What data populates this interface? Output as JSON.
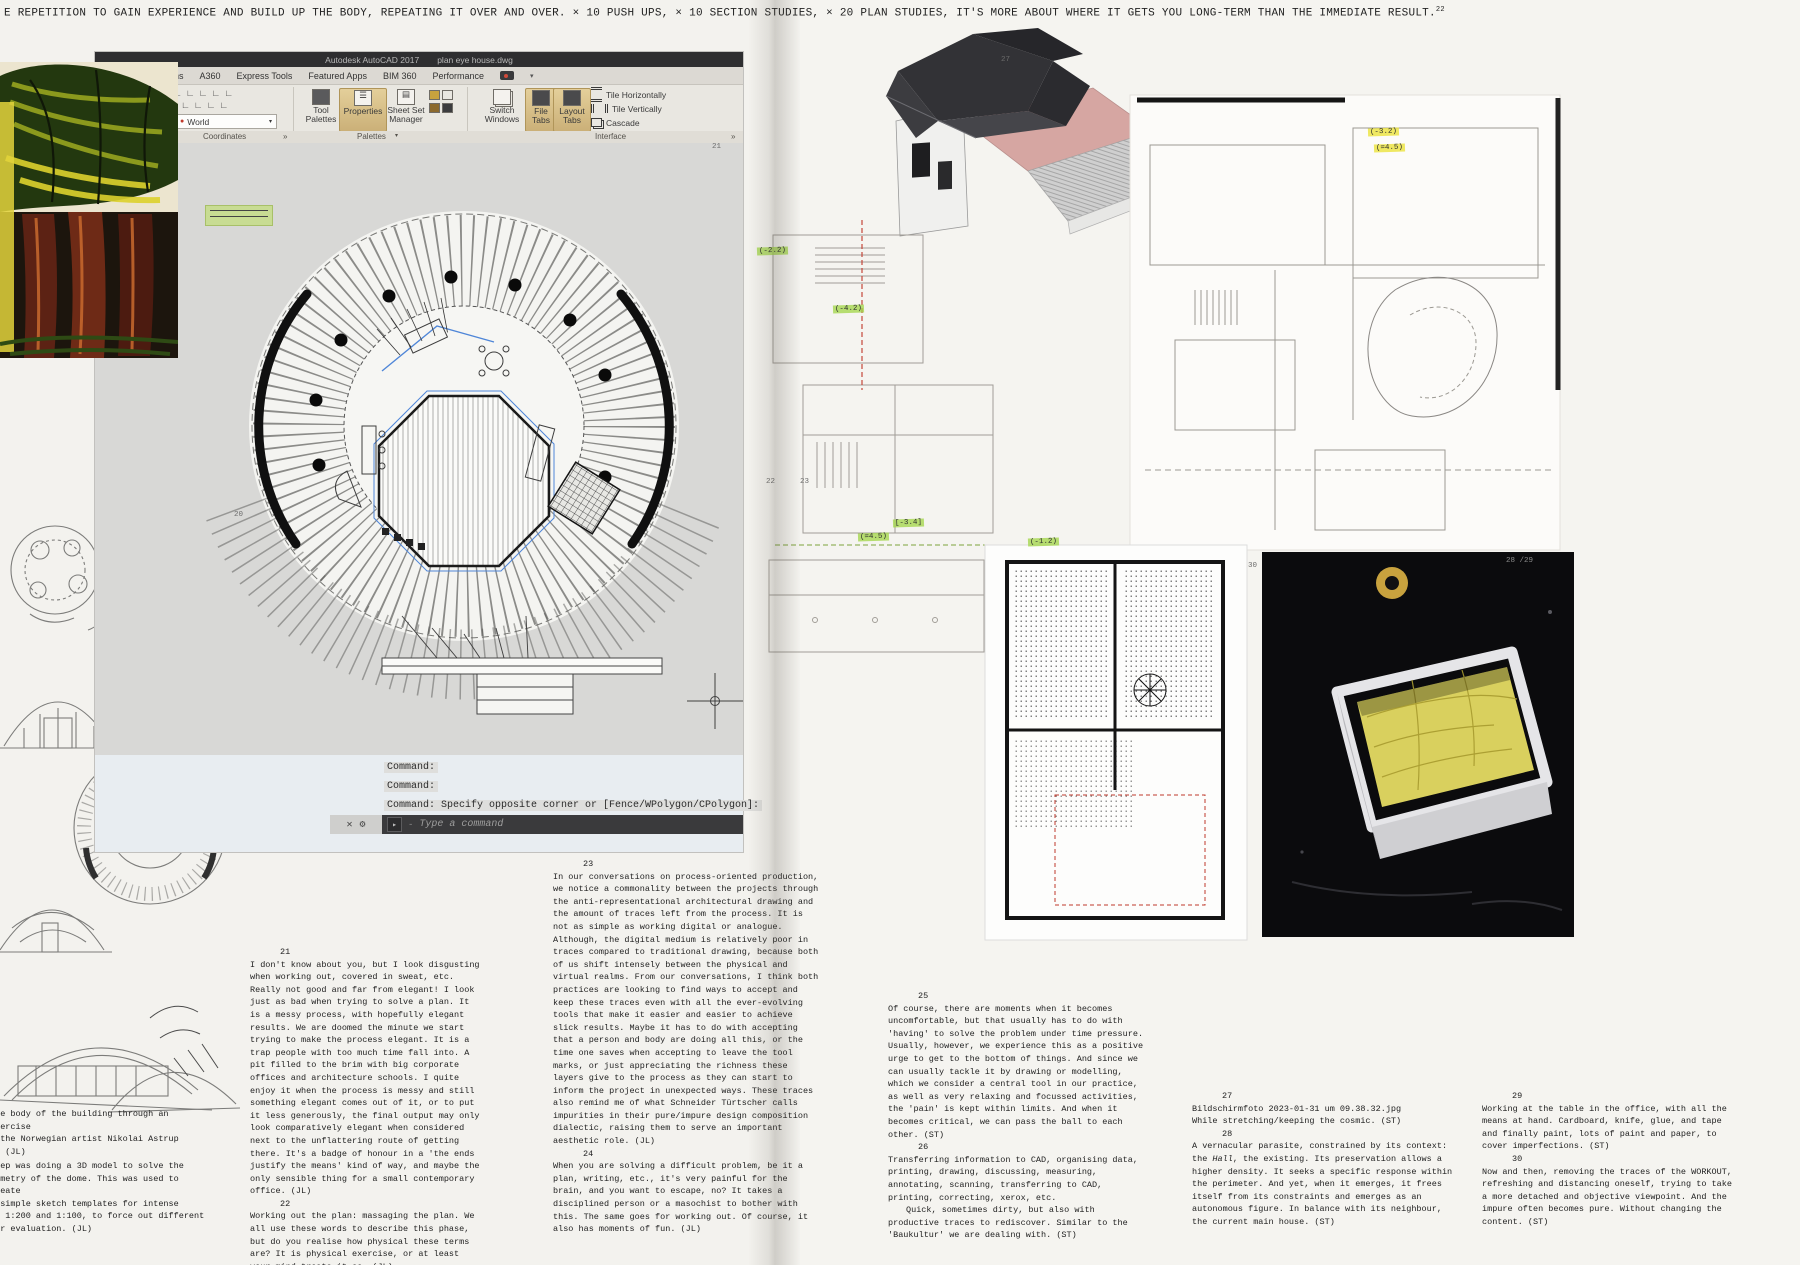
{
  "header": {
    "text": "E REPETITION TO GAIN EXPERIENCE AND BUILD UP THE BODY, REPEATING IT OVER AND OVER. × 10 PUSH UPS, × 10 SECTION STUDIES, × 20 PLAN STUDIES, IT'S MORE ABOUT WHERE IT GETS YOU LONG-TERM THAN THE IMMEDIATE RESULT.",
    "footnote_ref": "22"
  },
  "autocad": {
    "titlebar": {
      "app_title": "Autodesk AutoCAD 2017",
      "doc_title": "plan eye house.dwg"
    },
    "menu_tabs": [
      "Add-ins",
      "A360",
      "Express Tools",
      "Featured Apps",
      "BIM 360",
      "Performance"
    ],
    "ribbon": {
      "partial_label": "amed",
      "world_dropdown": "World",
      "tool_palettes": "Tool Palettes",
      "properties": "Properties",
      "sheet_set_manager": "Sheet Set Manager",
      "switch_windows": "Switch Windows",
      "file_tabs": "File Tabs",
      "layout_tabs": "Layout Tabs",
      "tile_horizontally": "Tile Horizontally",
      "tile_vertically": "Tile Vertically",
      "cascade": "Cascade",
      "panel_labels": {
        "coordinates": "Coordinates",
        "palettes": "Palettes",
        "interface": "Interface"
      }
    },
    "icons": {
      "caret": "▾",
      "expand": "»",
      "close": "✕",
      "wrench": "⚙",
      "prompt": "▸",
      "dash": "-",
      "dot": "●"
    },
    "command_area": {
      "line1": "Command:",
      "line2": "Command:",
      "line3": "Command: Specify opposite corner or [Fence/WPolygon/CPolygon]:",
      "prompt_placeholder": "Type a command"
    }
  },
  "footnotes": {
    "left": [
      {
        "num": "21",
        "text": "I don't know about you, but I look disgusting when working out, covered in sweat, etc. Really not good and far from elegant! I look just as bad when trying to solve a plan. It is a messy process, with hopefully elegant results. We are doomed the minute we start trying to make the process elegant. It is a trap people with too much time fall into. A pit filled to the brim with big corporate offices and architecture schools. I quite enjoy it when the process is messy and still something elegant comes out of it, or to put it less generously, the final output may only look comparatively elegant when considered next to the unflattering route of getting there. It's a badge of honour in a 'the ends justify the means' kind of way, and maybe the only sensible thing for a small contemporary office. (JL)"
      },
      {
        "num": "22",
        "text": "Working out the plan: massaging the plan. We all use these words to describe this phase, but do you realise how physical these terms are? It is physical exercise, or at least your mind treats it so. (JL)"
      }
    ],
    "middle": [
      {
        "num": "23",
        "text": "In our conversations on process-oriented production, we notice a commonality between the projects through the anti-representational architectural drawing and the amount of traces left from the process. It is not as simple as working digital or analogue. Although, the digital medium is relatively poor in traces compared to traditional drawing, because both of us shift intensely between the physical and virtual realms. From our conversations, I think both practices are looking to find ways to accept and keep these traces even with all the ever-evolving tools that make it easier and easier to achieve slick results. Maybe it has to do with accepting that a person and body are doing all this, or the time one saves when accepting to leave the tool marks, or just appreciating the richness these layers give to the process as they can start to inform the project in unexpected ways. These traces also remind me of what Schneider Türtscher calls impurities in their pure/impure design composition dialectic, raising them to serve an important aesthetic role. (JL)"
      },
      {
        "num": "24",
        "text": "When you are solving a difficult problem, be it a plan, writing, etc., it's very painful for the brain, and you want to escape, no? It takes a disciplined person or a masochist to bother with this. The same goes for working out. Of course, it also has moments of fun. (JL)"
      }
    ],
    "right1": [
      {
        "num": "25",
        "text": "Of course, there are moments when it becomes uncomfortable, but that usually has to do with 'having' to solve the problem under time pressure. Usually, however, we experience this as a positive urge to get to the bottom of things. And since we can usually tackle it by drawing or modelling, which we consider a central tool in our practice, as well as very relaxing and focussed activities, the 'pain' is kept within limits. And when it becomes critical, we can pass the ball to each other. (ST)"
      },
      {
        "num": "26",
        "text": "Transferring information to CAD, organising data, printing, drawing, discussing, measuring, annotating, scanning, transferring to CAD, printing, correcting, xerox, etc.",
        "text2": "Quick, sometimes dirty, but also with productive traces to rediscover. Similar to the 'Baukultur' we are dealing with. (ST)"
      }
    ],
    "right2": [
      {
        "num": "27",
        "line1": "Bildschirmfoto 2023-01-31 um 09.38.32.jpg",
        "line2": "While stretching/keeping the cosmic. (ST)"
      },
      {
        "num": "28",
        "text_pre": "A vernacular parasite, constrained by its context: the ",
        "text_italic": "Hall",
        "text_post": ", the existing. Its preservation allows a higher density. It seeks a specific response within the perimeter. And yet, when it emerges, it frees itself from its constraints and emerges as an autonomous figure. In balance with its neighbour, the current main house. (ST)"
      }
    ],
    "right3": [
      {
        "num": "29",
        "text": "Working at the table in the office, with all the means at hand. Cardboard, knife, glue, and tape and finally paint, lots of paint and paper, to cover imperfections. (ST)"
      },
      {
        "num": "30",
        "text": "Now and then, removing the traces of the WORKOUT, refreshing and distancing oneself, trying to take a more detached and objective viewpoint. And the impure often becomes pure. Without changing the content. (ST)"
      }
    ]
  },
  "captions_left": {
    "caption1": "the body of the building through an exercise\ny the Norwegian artist Nikolai Astrup\n). (JL)",
    "caption2": "step was doing a 3D model to solve the\neometry of the dome. This was used to create\nf simple sketch templates for intense\nin 1:200 and 1:100, to force out different\nfor evaluation. (JL)"
  },
  "annotations": {
    "pencil_markers": [
      "20",
      "21",
      "22",
      "23",
      "27",
      "30",
      "28 /29"
    ],
    "green_notes": [
      "(-2.2)",
      "(-4.2)",
      "[-3.4]",
      "(=4.5)",
      "(-1.2)"
    ],
    "yellow_notes": [
      "(-3.2)",
      "(=4.5)"
    ]
  },
  "colors": {
    "paper": "#f3f2ee",
    "cad_canvas": "#d8d8d6",
    "ribbon_gold": "#cbb078",
    "highlight_green": "#a0d646",
    "highlight_yellow": "#ebe43c",
    "roof_pink": "#d6a6a2",
    "model_yellow": "#d9d05e",
    "photo_black": "#0b0b0d"
  }
}
